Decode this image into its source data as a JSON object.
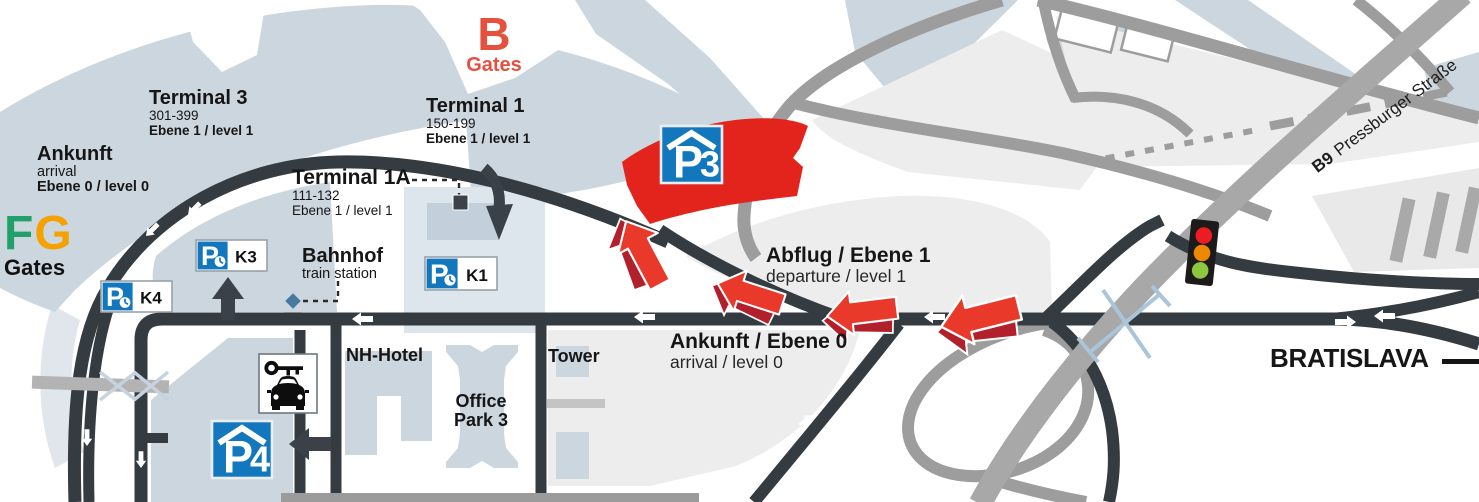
{
  "colors": {
    "accent_red": "#e2241c",
    "parking_blue": "#1377bd",
    "building_blue_gray": "#ccd6df",
    "road_dark": "#343b41",
    "road_gray": "#9d9d9d",
    "gate_f_green": "#22a06b",
    "gate_g_orange": "#f5a200",
    "traffic_red": "#ec1c24",
    "traffic_amber": "#f08700",
    "traffic_green": "#8dc63f"
  },
  "gates": {
    "b_letter": "B",
    "b_word": "Gates",
    "f_letter": "F",
    "g_letter": "G",
    "fg_word": "Gates"
  },
  "terminals": {
    "t3": {
      "name": "Terminal 3",
      "gates": "301-399",
      "level": "Ebene 1 / level 1"
    },
    "t1": {
      "name": "Terminal 1",
      "gates": "150-199",
      "level": "Ebene 1 / level 1"
    },
    "t1a": {
      "name": "Terminal 1A",
      "gates": "111-132",
      "level": "Ebene 1 / level 1"
    }
  },
  "arrival_hall": {
    "name": "Ankunft",
    "sub": "arrival",
    "level": "Ebene 0 / level 0"
  },
  "station": {
    "name": "Bahnhof",
    "sub": "train station"
  },
  "roads": {
    "departure_bold": "Abflug / Ebene 1",
    "departure_sub": "departure / level 1",
    "arrival_bold": "Ankunft / Ebene 0",
    "arrival_sub": "arrival / level 0",
    "bratislava": "BRATISLAVA",
    "b9": "B9",
    "b9_street": "Pressburger Straße"
  },
  "buildings": {
    "nh_hotel": "NH-Hotel",
    "office_park_1": "Office",
    "office_park_2": "Park 3",
    "tower": "Tower"
  },
  "parking": {
    "p3": {
      "p": "P",
      "num": "3"
    },
    "p4": {
      "p": "P",
      "num": "4"
    },
    "k1": {
      "p": "P",
      "label": "K1"
    },
    "k3": {
      "p": "P",
      "label": "K3"
    },
    "k4": {
      "p": "P",
      "label": "K4"
    }
  }
}
